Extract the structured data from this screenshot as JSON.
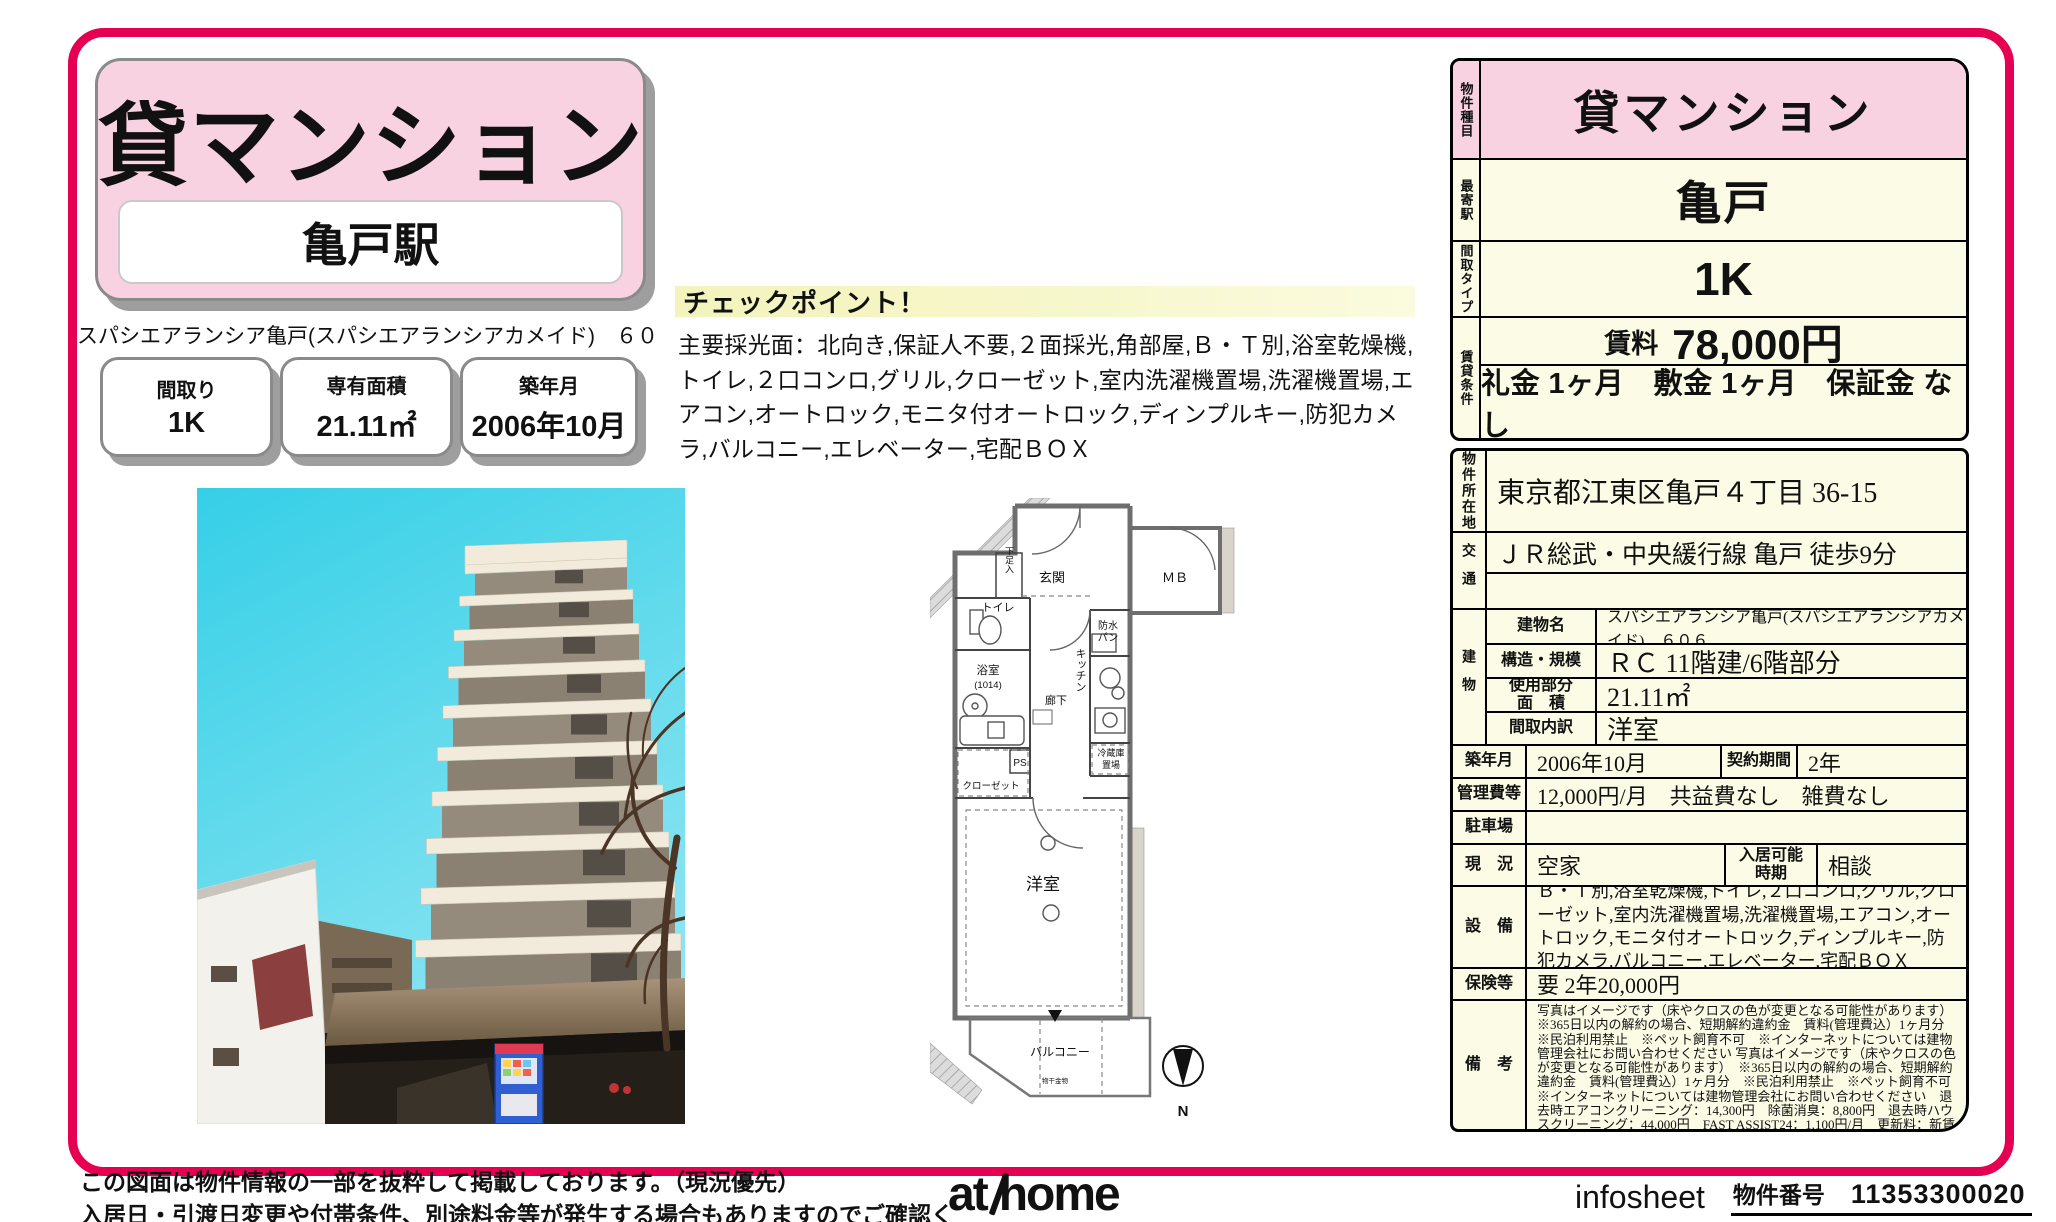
{
  "colors": {
    "accent_border": "#e50051",
    "pink": "#f8d2e0",
    "cream": "#fcfce6",
    "highlight_yellow": "#f5f5c5"
  },
  "header": {
    "property_type": "貸マンション",
    "station": "亀戸駅",
    "building_line": "スパシエアランシア亀戸(スパシエアランシアカメイド)　６０６",
    "badges": [
      {
        "label": "間取り",
        "value": "1K"
      },
      {
        "label": "専有面積",
        "value": "21.11㎡"
      },
      {
        "label": "築年月",
        "value": "2006年10月"
      }
    ]
  },
  "checkpoint": {
    "title": "チェックポイント！",
    "body": "主要採光面：北向き,保証人不要,２面採光,角部屋,Ｂ・Ｔ別,浴室乾燥機,トイレ,２口コンロ,グリル,クローゼット,室内洗濯機置場,洗濯機置場,エアコン,オートロック,モニタ付オートロック,ディンプルキー,防犯カメラ,バルコニー,エレベーター,宅配ＢＯＸ"
  },
  "floorplan": {
    "genkan": "玄関",
    "mb": "ＭＢ",
    "shoe_box": "下足入",
    "toilet": "トイレ",
    "pan_l1": "防水",
    "pan_l2": "パン",
    "bath_l1": "浴室",
    "bath_l2": "(1014)",
    "kitchen": "キッチン",
    "hall": "廊下",
    "ps": "PS",
    "closet": "クローゼット",
    "fridge_l1": "冷蔵庫",
    "fridge_l2": "置場",
    "room": "洋室",
    "balcony": "バルコニー",
    "laundry_pole": "物干金物",
    "compass_n": "N"
  },
  "summary": {
    "type_label": "物件種目",
    "type_value": "貸マンション",
    "station_label": "最寄駅",
    "station_value": "亀戸",
    "layout_label": "間取タイプ",
    "layout_value": "1K",
    "terms_label": "賃貸条件",
    "rent_label": "賃料",
    "rent_value": "78,000円",
    "terms_value": "礼金 1ヶ月　敷金 1ヶ月　保証金 なし"
  },
  "details": {
    "location_label": "物件所在地",
    "location": "東京都江東区亀戸４丁目 36-15",
    "access_label": "交通",
    "access": "ＪＲ総武・中央緩行線 亀戸 徒歩9分",
    "access2": "",
    "building_label": "建物",
    "building_name_label": "建物名",
    "building_name": "スパシエアランシア亀戸(スパシエアランシアカメイド)　６０６",
    "structure_label": "構造・規模",
    "structure": "ＲＣ 11階建/6階部分",
    "area_label": "使用部分\n面　積",
    "area": "21.11㎡",
    "layout_detail_label": "間取内訳",
    "layout_detail": "洋室",
    "built_label": "築年月",
    "built": "2006年10月",
    "contract_label": "契約期間",
    "contract": "2年",
    "fees_label": "管理費等",
    "fees": "12,000円/月　共益費なし　雑費なし",
    "parking_label": "駐車場",
    "parking": "",
    "status_label": "現　況",
    "status": "空家",
    "movein_label": "入居可能\n時期",
    "movein": "相談",
    "equipment_label": "設　備",
    "equipment": "Ｂ・Ｔ別,浴室乾燥機,トイレ,２口コンロ,グリル,クローゼット,室内洗濯機置場,洗濯機置場,エアコン,オートロック,モニタ付オートロック,ディンプルキー,防犯カメラ,バルコニー,エレベーター,宅配ＢＯＸ",
    "insurance_label": "保険等",
    "insurance": "要 2年20,000円",
    "remarks_label": "備　考",
    "remarks": "写真はイメージです（床やクロスの色が変更となる可能性があります）　※365日以内の解約の場合、短期解約違約金　賃料(管理費込）1ヶ月分　※民泊利用禁止　※ペット飼育不可　※インターネットについては建物管理会社にお問い合わせください 写真はイメージです（床やクロスの色が変更となる可能性があります）　※365日以内の解約の場合、短期解約違約金　賃料(管理費込）1ヶ月分　※民泊利用禁止　※ペット飼育不可　※インターネットについては建物管理会社にお問い合わせください　退去時エアコンクリーニング：14,300円　除菌消臭：8,800円　退去時ハウスクリーニング：44,000円　FAST ASSIST24：1,100円/月　更新料：新賃料１ヶ月　賃貸保証：加入要 保証料（初回契約時）40%、保証料（年間）10,000円、その他プラン有（新日本信用保証の場合 口座振替手数料216円（税込）/月）"
  },
  "footer": {
    "disclaimer_line1": "この図面は物件情報の一部を抜粋して掲載しております。（現況優先）",
    "disclaimer_line2": "入居日・引渡日変更や付帯条件、別途料金等が発生する場合もありますのでご確認ください。",
    "logo_at": "at",
    "logo_home": "home",
    "sheet_name": "infosheet",
    "property_no_label": "物件番号",
    "property_no": "11353300020"
  }
}
